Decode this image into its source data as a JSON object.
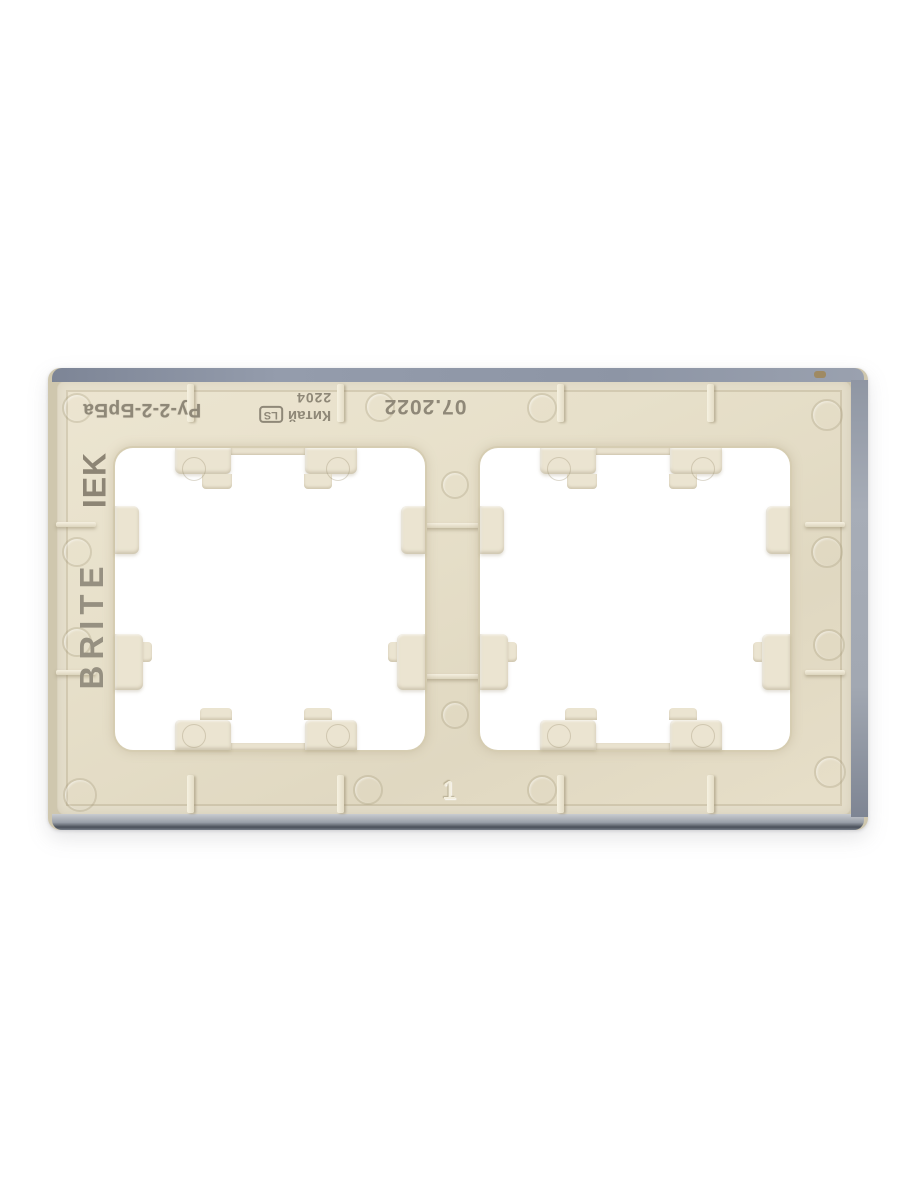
{
  "photo": {
    "subject": "Rear side of a beige IEK BRITE two-gang wall switch/socket frame on a white background",
    "background_color": "#ffffff",
    "plastic_color": "#e7e0ca",
    "front_edge_color": "#8e96a6",
    "markings": {
      "model_code": "Ру-2-2-БрБа",
      "country": "Китай",
      "mold_stamp": "LS",
      "batch_code": "2204",
      "date_code": "07.2022",
      "brand": "IEK",
      "series": "BRITE",
      "cavity_number": "1"
    }
  }
}
